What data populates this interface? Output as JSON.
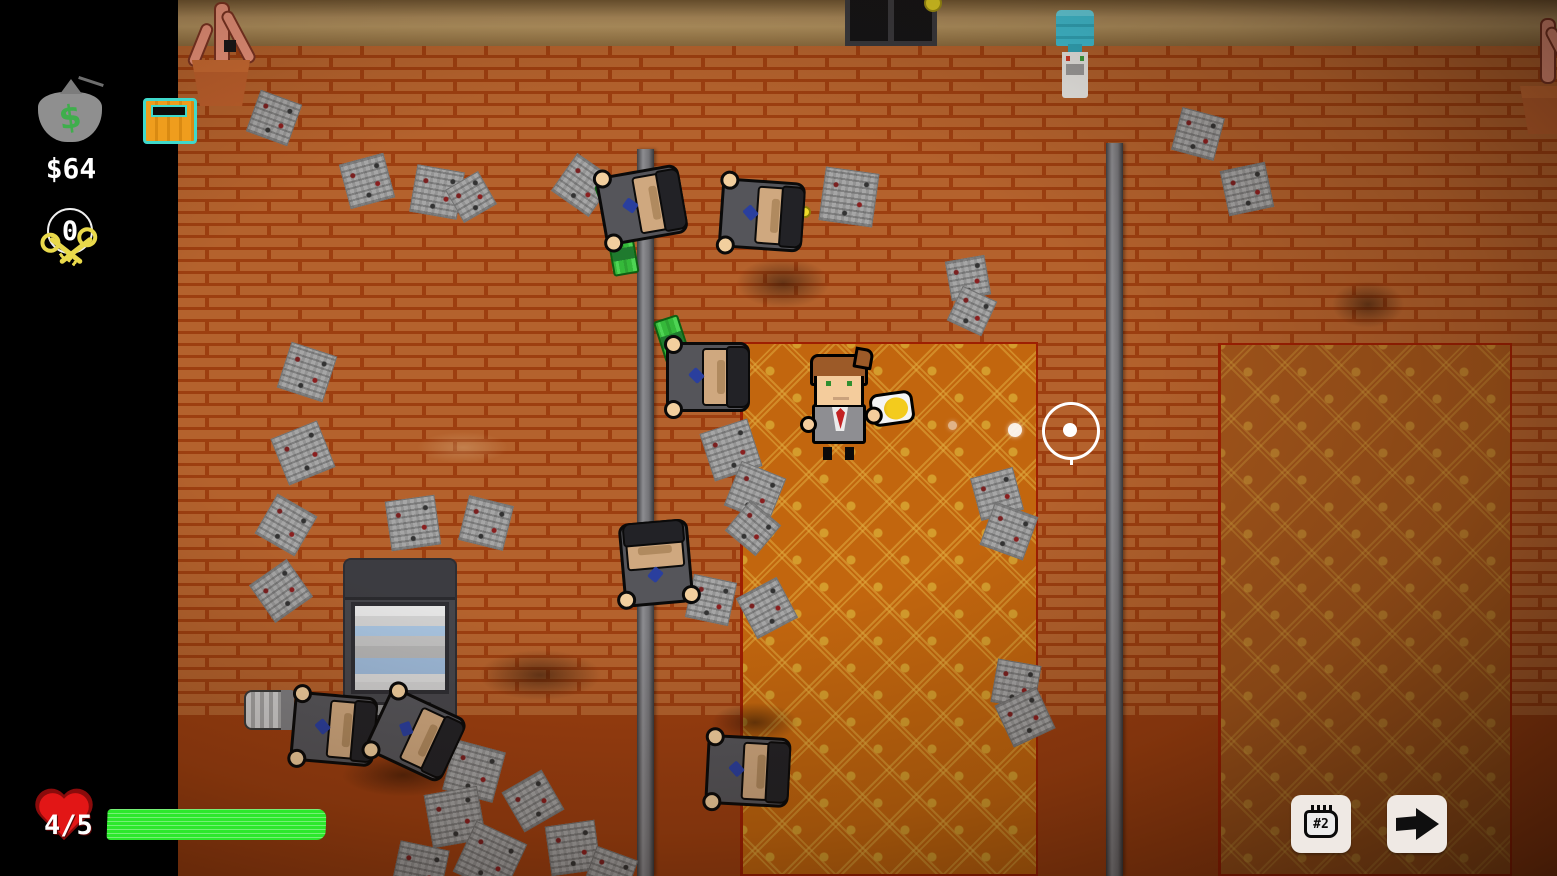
{
  "hud": {
    "money_label": "$64",
    "money_bag_symbol": "$",
    "keys_count": "0",
    "health_label": "4/5",
    "health_current": 4,
    "health_max": 5,
    "weapon_slot_label": "#2"
  },
  "colors": {
    "health_green": "#2ce82c",
    "brick": "#b4622d",
    "mortar": "#9d3f10",
    "carpet_center": "#c2660e",
    "carpet_right": "#a4561b",
    "chest_teal": "#3fd9cb",
    "chest_orange": "#ef9d1d",
    "coin_yellow": "#efdc2a",
    "heart_red": "#e21616",
    "money_green": "#35b93a"
  },
  "scene": {
    "stains": [
      {
        "x": 718,
        "y": 248,
        "w": 130,
        "h": 70,
        "t": "dark"
      },
      {
        "x": 455,
        "y": 640,
        "w": 170,
        "h": 70,
        "t": "dark"
      },
      {
        "x": 318,
        "y": 745,
        "w": 170,
        "h": 60,
        "t": "dark"
      },
      {
        "x": 1318,
        "y": 272,
        "w": 100,
        "h": 65,
        "t": "dark"
      },
      {
        "x": 695,
        "y": 695,
        "w": 120,
        "h": 55,
        "t": "dark"
      },
      {
        "x": 398,
        "y": 425,
        "w": 130,
        "h": 45,
        "t": "light"
      }
    ],
    "papers": [
      {
        "x": 252,
        "y": 96,
        "s": 44,
        "r": 20
      },
      {
        "x": 344,
        "y": 158,
        "s": 46,
        "r": -15
      },
      {
        "x": 413,
        "y": 168,
        "s": 48,
        "r": 10
      },
      {
        "x": 452,
        "y": 178,
        "s": 38,
        "r": -30
      },
      {
        "x": 560,
        "y": 162,
        "s": 46,
        "r": 35
      },
      {
        "x": 822,
        "y": 170,
        "s": 54,
        "r": 8
      },
      {
        "x": 948,
        "y": 258,
        "s": 40,
        "r": -10
      },
      {
        "x": 953,
        "y": 292,
        "s": 38,
        "r": 25
      },
      {
        "x": 1176,
        "y": 112,
        "s": 44,
        "r": 15
      },
      {
        "x": 1224,
        "y": 166,
        "s": 46,
        "r": -12
      },
      {
        "x": 283,
        "y": 348,
        "s": 48,
        "r": 18
      },
      {
        "x": 278,
        "y": 428,
        "s": 50,
        "r": -22
      },
      {
        "x": 263,
        "y": 502,
        "s": 46,
        "r": 30
      },
      {
        "x": 388,
        "y": 498,
        "s": 50,
        "r": -8
      },
      {
        "x": 463,
        "y": 500,
        "s": 46,
        "r": 14
      },
      {
        "x": 258,
        "y": 568,
        "s": 46,
        "r": -35
      },
      {
        "x": 706,
        "y": 425,
        "s": 50,
        "r": -18
      },
      {
        "x": 731,
        "y": 468,
        "s": 48,
        "r": 22
      },
      {
        "x": 733,
        "y": 508,
        "s": 40,
        "r": 40
      },
      {
        "x": 689,
        "y": 578,
        "s": 44,
        "r": 12
      },
      {
        "x": 744,
        "y": 585,
        "s": 46,
        "r": -28
      },
      {
        "x": 975,
        "y": 472,
        "s": 44,
        "r": -15
      },
      {
        "x": 986,
        "y": 508,
        "s": 46,
        "r": 20
      },
      {
        "x": 994,
        "y": 662,
        "s": 44,
        "r": 10
      },
      {
        "x": 1002,
        "y": 694,
        "s": 46,
        "r": -25
      },
      {
        "x": 448,
        "y": 745,
        "s": 52,
        "r": 15
      },
      {
        "x": 428,
        "y": 790,
        "s": 54,
        "r": -10
      },
      {
        "x": 462,
        "y": 830,
        "s": 56,
        "r": 25
      },
      {
        "x": 395,
        "y": 845,
        "s": 50,
        "r": 12
      },
      {
        "x": 548,
        "y": 823,
        "s": 50,
        "r": -8
      },
      {
        "x": 510,
        "y": 778,
        "s": 46,
        "r": -30
      },
      {
        "x": 588,
        "y": 852,
        "s": 44,
        "r": 20
      }
    ],
    "money_stacks": [
      {
        "x": 597,
        "y": 178,
        "r": -20
      },
      {
        "x": 601,
        "y": 240,
        "r": 80
      },
      {
        "x": 650,
        "y": 326,
        "r": 72
      }
    ],
    "coins": [
      {
        "x": 733,
        "y": 208
      },
      {
        "x": 799,
        "y": 206
      },
      {
        "x": 396,
        "y": 733
      }
    ],
    "guards": [
      {
        "x": 596,
        "y": 166,
        "r": -10
      },
      {
        "x": 716,
        "y": 176,
        "r": 4
      },
      {
        "x": 662,
        "y": 338,
        "r": 0
      },
      {
        "x": 610,
        "y": 524,
        "r": -95
      },
      {
        "x": 702,
        "y": 732,
        "r": 3
      },
      {
        "x": 288,
        "y": 690,
        "r": 5
      },
      {
        "x": 370,
        "y": 696,
        "r": 25
      }
    ],
    "bullets": [
      {
        "x": 948,
        "y": 421,
        "d": 9,
        "o": 0.5
      },
      {
        "x": 1008,
        "y": 423,
        "d": 14,
        "o": 0.9
      }
    ]
  }
}
